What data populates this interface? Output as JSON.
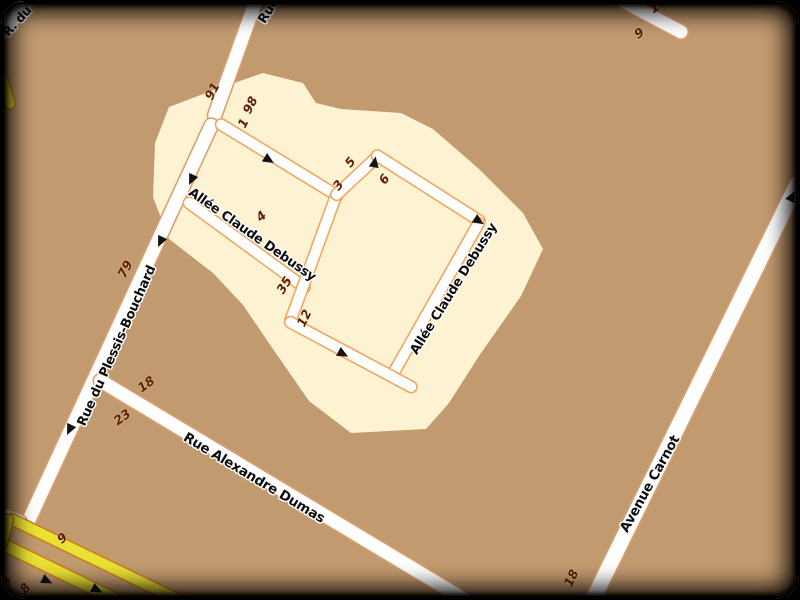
{
  "map": {
    "type": "openstreetmap-style-tile",
    "colors": {
      "background": "#c19a6f",
      "highlight_region": "#fdf3d3",
      "road_fill": "#ffffff",
      "road_casing": "#dba06e",
      "highlight_road_casing": "#f2a660",
      "yellow_road_fill": "#e9e133",
      "yellow_road_casing": "#c8831e",
      "house_number_text": "#5e1f06",
      "street_label_text": "#0d0d0d",
      "frame": "#000000"
    },
    "icons": {
      "one_way_arrow": "black triangle ▶ oriented along travel direction"
    },
    "street_labels": [
      {
        "text": "R. du"
      },
      {
        "text": "Rue"
      },
      {
        "text": "Rue du Plessis-Bouchard"
      },
      {
        "text": "Allée Claude Debussy"
      },
      {
        "text": "Allée Claude Debussy"
      },
      {
        "text": "Rue Alexandre Dumas"
      },
      {
        "text": "Avenue Carnot"
      }
    ],
    "house_numbers": [
      {
        "text": "91"
      },
      {
        "text": "98"
      },
      {
        "text": "1"
      },
      {
        "text": "4"
      },
      {
        "text": "5"
      },
      {
        "text": "3"
      },
      {
        "text": "6"
      },
      {
        "text": "35"
      },
      {
        "text": "12"
      },
      {
        "text": "79"
      },
      {
        "text": "18"
      },
      {
        "text": "23"
      },
      {
        "text": "18"
      },
      {
        "text": "14"
      },
      {
        "text": "9"
      },
      {
        "text": "9"
      },
      {
        "text": "8"
      },
      {
        "text": "14"
      }
    ]
  }
}
